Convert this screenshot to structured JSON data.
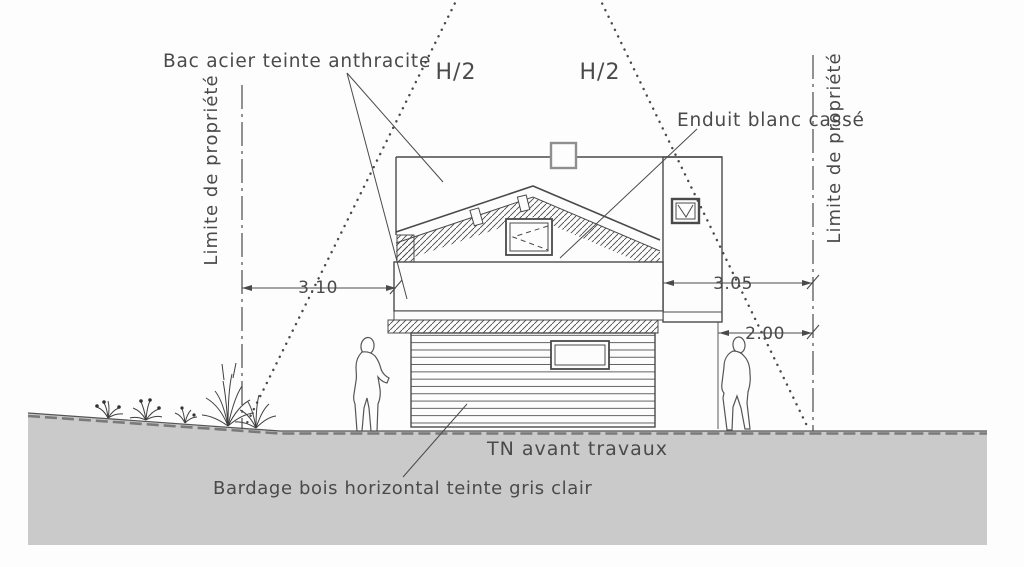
{
  "drawing": {
    "type": "architectural-elevation",
    "labels": {
      "bac_acier": "Bac acier teinte anthracite",
      "enduit": "Enduit blanc cassé",
      "bardage": "Bardage bois horizontal teinte gris clair",
      "tn": "TN avant travaux",
      "limite_left": "Limite de propriété",
      "limite_right": "Limite de propriété",
      "h2_left": "H/2",
      "h2_right": "H/2"
    },
    "dimensions": {
      "d310": "3.10",
      "d305": "3.05",
      "d200": "2.00"
    },
    "colors": {
      "background": "#fdfdfd",
      "line": "#4a4a4a",
      "ground": "#cacaca"
    }
  }
}
